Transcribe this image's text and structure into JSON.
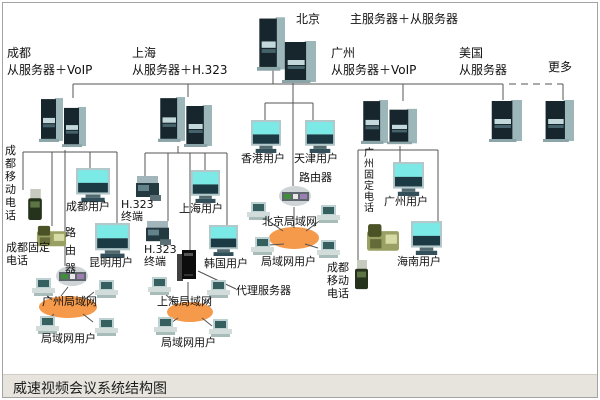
{
  "diagram_title": "威速视频会议系统结构图",
  "colors": {
    "lan_cloud": "#f5994a",
    "connector_line": "#555555",
    "monitor_screen": "#7be9e5",
    "title_bar_bg": "#e7e4de"
  },
  "hq": {
    "city": "北京",
    "role": "主服务器＋从服务器"
  },
  "branches": {
    "chengdu": {
      "city": "成都",
      "role": "从服务器＋VoIP"
    },
    "shanghai": {
      "city": "上海",
      "role": "从服务器＋H.323"
    },
    "guangzhou": {
      "city": "广州",
      "role": "从服务器＋VoIP"
    },
    "usa": {
      "city": "美国",
      "role": "从服务器"
    },
    "more": "更多"
  },
  "labels": {
    "hongkong_user": "香港用户",
    "tianjin_user": "天津用户",
    "router": "路由器",
    "chengdu_user": "成都用户",
    "h323_terminal": "H.323\n终端",
    "shanghai_user": "上海用户",
    "kunming_user": "昆明用户",
    "korea_user": "韩国用户",
    "beijing_lan": "北京局域网",
    "shanghai_lan": "上海局域网",
    "guangzhou_lan": "广州局域网",
    "lan_users": "局域网用户",
    "proxy_server": "代理服务器",
    "chengdu_mobile_phone": "成都移动电话",
    "chengdu_fixed_phone": "成都固定电话",
    "guangzhou_fixed_phone": "广州固定电话",
    "guangzhou_user": "广州用户",
    "hainan_user": "海南用户"
  }
}
